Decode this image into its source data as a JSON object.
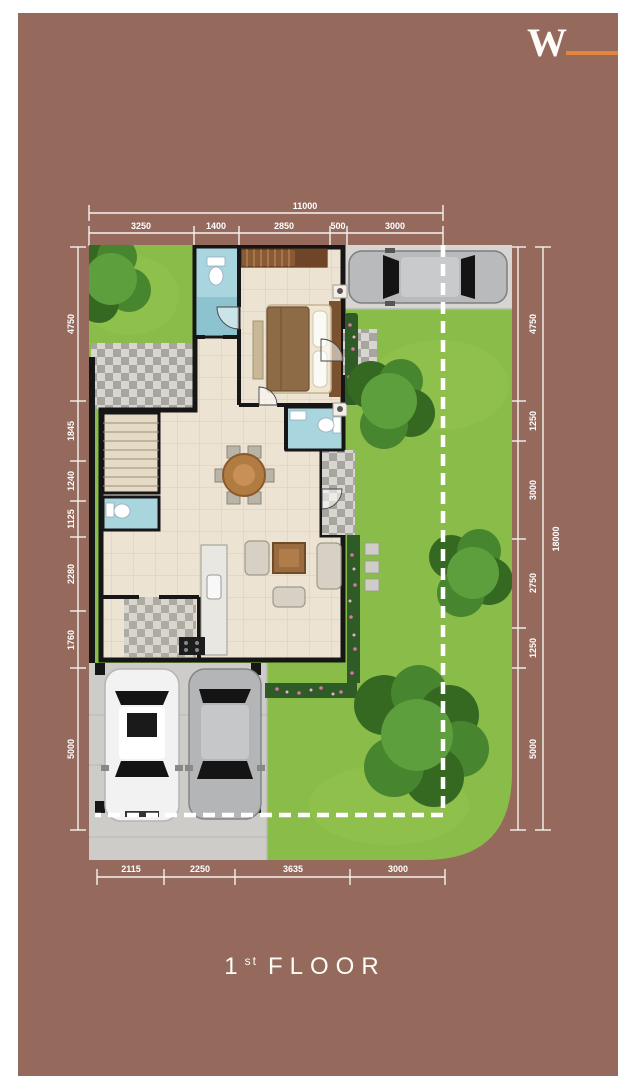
{
  "logo": {
    "letter": "W",
    "accent_color": "#e2853e"
  },
  "title": {
    "number": "1",
    "ordinal": "st",
    "word": "FLOOR"
  },
  "dimensions": {
    "top_total": "11000",
    "top": [
      "3250",
      "1400",
      "2850",
      "500",
      "3000"
    ],
    "left": [
      "4750",
      "1845",
      "1240",
      "1125",
      "2280",
      "1760",
      "5000"
    ],
    "right": [
      "4750",
      "1250",
      "3000",
      "2750",
      "1250",
      "5000"
    ],
    "right_total": "18000",
    "bottom": [
      "2115",
      "2250",
      "3635",
      "3000"
    ]
  },
  "colors": {
    "bg": "#95695c",
    "accent": "#e2853e",
    "dimension_text": "#ffffff",
    "lawn": "#8abc49",
    "concrete": "#d6d5d2",
    "wall": "#161616",
    "floor": "#ece3d2",
    "bathroom": "#a9d6de",
    "title_text": "#fdfdf8"
  },
  "plan": {
    "boundary_style": "dashed-white",
    "features": [
      "master-bedroom",
      "bathroom",
      "bathroom-2",
      "bathroom-3",
      "dining-area",
      "kitchen",
      "living-area",
      "stairs",
      "carport",
      "driveway",
      "garden",
      "trees",
      "cars"
    ]
  }
}
